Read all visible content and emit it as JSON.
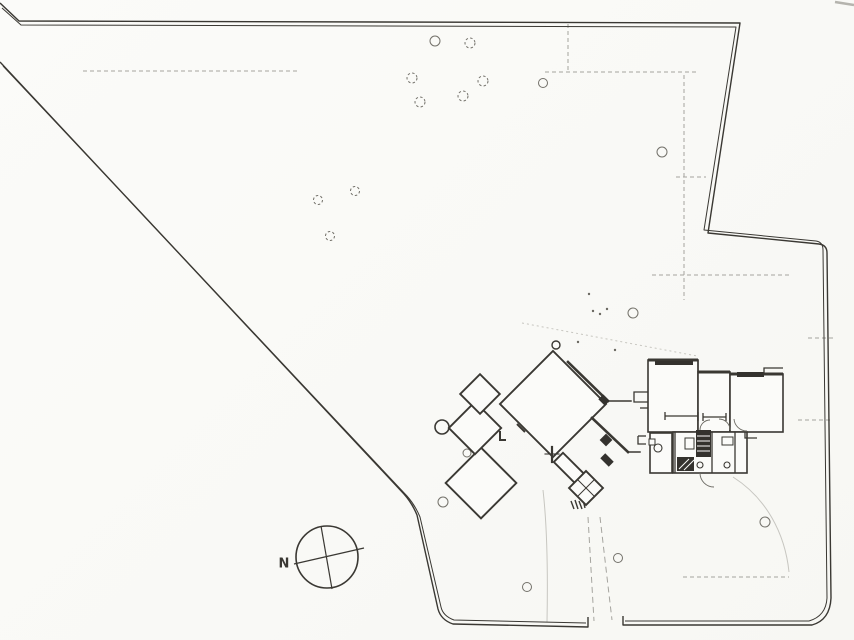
{
  "document": {
    "kind": "architectural site plan (scanned line drawing)",
    "compass_label": "N"
  },
  "palette": {
    "paper": "#fbfbf9",
    "ink": "#3a3833",
    "ink_light": "#6b6962",
    "fill_dark": "#34322e",
    "faint": "#c7c6c0",
    "dashed": "#a5a49e",
    "tree": "#73716a",
    "smudge": "#b5b4ae"
  },
  "compass": {
    "label": "N",
    "cx": 327,
    "cy": 557,
    "r": 31,
    "needles": [
      [
        294,
        564,
        364,
        548
      ],
      [
        321,
        526,
        332,
        589
      ]
    ],
    "label_x": 284,
    "label_y": 562,
    "label_size": 13
  },
  "site": {
    "boundary_outer": [
      "M 0 3 L 19 21 L 740 23 L 708 233 L 819 244 Q 827 245 827 253 L 831 598 Q 830 620 812 625 L 623 625 L 623 616",
      "M 0 62 L 404 494 Q 412 503 417 515 L 438 609 Q 441 620 453 624 L 588 627 L 588 617"
    ],
    "boundary_inner": [
      "M 2 8 L 21 25 L 736 27 L 704 230 L 816 241 Q 823 242 823 250 L 827 598 Q 826 616 809 621 L 625 621",
      "M 3 66 L 407 496 Q 415 505 420 517 L 441 607 Q 443 616 454 620 L 586 623"
    ],
    "dashed_lines": [
      {
        "d": "M 83 71 L 300 71"
      },
      {
        "d": "M 545 72 L 697 72"
      },
      {
        "d": "M 568 24 L 568 71"
      },
      {
        "d": "M 684 75 L 684 300"
      },
      {
        "d": "M 652 275 L 792 275"
      },
      {
        "d": "M 676 177 L 706 177"
      },
      {
        "d": "M 808 338 L 833 338"
      },
      {
        "d": "M 798 420 L 833 420"
      },
      {
        "d": "M 683 577 L 789 577"
      },
      {
        "d": "M 522 323 L 697 356",
        "light": true
      }
    ],
    "driveway_dashed": [
      "M 588 517 L 594 621",
      "M 600 517 L 612 620"
    ],
    "faint_paths": [
      "M 543 490 C 547 525 548 570 547 622",
      "M 733 477 C 766 498 785 533 789 572"
    ],
    "scribble": "M 571 501 L 574 509 M 575 500 L 578 509 M 579 501 L 582 509 M 583 500 L 585 508",
    "smudge": "M 835 2 L 854 5",
    "dots": [
      [
        593,
        311
      ],
      [
        600,
        314
      ],
      [
        607,
        309
      ],
      [
        589,
        294
      ],
      [
        578,
        342
      ],
      [
        615,
        350
      ],
      [
        712,
        394
      ],
      [
        716,
        398
      ]
    ],
    "trees": [
      {
        "x": 435,
        "y": 41,
        "r": 5
      },
      {
        "x": 470,
        "y": 43,
        "r": 5,
        "dashed": true
      },
      {
        "x": 412,
        "y": 78,
        "r": 5,
        "dashed": true
      },
      {
        "x": 483,
        "y": 81,
        "r": 5,
        "dashed": true
      },
      {
        "x": 543,
        "y": 83,
        "r": 4.5
      },
      {
        "x": 463,
        "y": 96,
        "r": 5,
        "dashed": true
      },
      {
        "x": 420,
        "y": 102,
        "r": 5,
        "dashed": true
      },
      {
        "x": 662,
        "y": 152,
        "r": 5
      },
      {
        "x": 355,
        "y": 191,
        "r": 4.5,
        "dashed": true
      },
      {
        "x": 318,
        "y": 200,
        "r": 4.5,
        "dashed": true
      },
      {
        "x": 330,
        "y": 236,
        "r": 4.5,
        "dashed": true
      },
      {
        "x": 633,
        "y": 313,
        "r": 5
      },
      {
        "x": 442,
        "y": 427,
        "r": 7,
        "bold": true
      },
      {
        "x": 467,
        "y": 453,
        "r": 4
      },
      {
        "x": 443,
        "y": 502,
        "r": 5
      },
      {
        "x": 618,
        "y": 558,
        "r": 4.5
      },
      {
        "x": 527,
        "y": 587,
        "r": 4.5
      },
      {
        "x": 765,
        "y": 522,
        "r": 5
      }
    ]
  },
  "building": {
    "diagonal_wing": {
      "rooms": [
        {
          "cx": 481,
          "cy": 483,
          "w": 50,
          "h": 50
        },
        {
          "cx": 475,
          "cy": 428,
          "w": 37,
          "h": 37
        },
        {
          "cx": 480,
          "cy": 394,
          "w": 28,
          "h": 28
        },
        {
          "cx": 553,
          "cy": 404,
          "w": 75,
          "h": 75
        },
        {
          "cx": 569,
          "cy": 468,
          "w": 30,
          "h": 13
        },
        {
          "cx": 586,
          "cy": 488,
          "w": 24,
          "h": 24
        }
      ],
      "x_lines": [
        "M 578 480 L 594 496",
        "M 594 480 L 578 496"
      ],
      "flag": {
        "cx": 556,
        "cy": 345,
        "r": 4
      },
      "walls": [
        {
          "d": "M 568 362 L 608 401",
          "w": 2.6
        },
        {
          "d": "M 608 401 L 631 401",
          "w": 1.5
        },
        {
          "d": "M 592 418 L 628 452",
          "w": 2.6
        },
        {
          "d": "M 628 452 L 640 452",
          "w": 1.5
        },
        {
          "d": "M 552 447 L 552 462",
          "w": 2.2
        },
        {
          "d": "M 545 454 L 559 454",
          "w": 1.1
        }
      ],
      "solids": [
        {
          "cx": 604,
          "cy": 400,
          "w": 9,
          "h": 7
        },
        {
          "cx": 606,
          "cy": 440,
          "w": 9,
          "h": 9
        },
        {
          "cx": 607,
          "cy": 460,
          "w": 12,
          "h": 7
        }
      ],
      "marks": [
        "M 500 431 L 500 440 L 506 440",
        "M 517 424 L 525 432"
      ]
    },
    "ortho_wing": {
      "rooms": [
        [
          648,
          360,
          50,
          72
        ],
        [
          698,
          372,
          32,
          60
        ],
        [
          730,
          374,
          53,
          58
        ],
        [
          673,
          432,
          74,
          41
        ],
        [
          650,
          433,
          22,
          40
        ]
      ],
      "thick_walls": [
        "M 648 360 L 698 360",
        "M 698 372 L 730 372",
        "M 730 374 L 783 374"
      ],
      "dark_bands": [
        [
          737,
          372,
          27,
          5
        ],
        [
          655,
          361,
          38,
          4
        ]
      ],
      "walls": [
        "M 665 416 L 698 416",
        "M 665 412 L 665 420",
        "M 698 412 L 698 421",
        "M 703 417 L 726 417",
        "M 703 413 L 703 421",
        "M 726 413 L 726 421",
        "M 698 360 L 698 372",
        "M 675 432 L 675 473",
        "M 712 432 L 712 473",
        "M 735 432 L 735 473",
        "M 648 392 L 634 392 L 634 402 L 648 402",
        "M 640 408 L 648 408",
        "M 638 436 L 646 436",
        "M 638 436 L 638 444 L 646 444",
        "M 745 432 L 745 438 L 757 438",
        "M 764 374 L 764 368 L 783 368"
      ],
      "stair_treads": {
        "rect": [
          696,
          430,
          15,
          27
        ],
        "tread_ys": [
          436,
          441,
          446,
          451
        ],
        "x1": 697,
        "x2": 710
      },
      "stair_diag": {
        "rect": [
          677,
          457,
          17,
          14
        ],
        "lines": [
          "M 679 469 L 689 459",
          "M 684 470 L 694 460"
        ]
      },
      "fixture_circles": [
        [
          658,
          448,
          4
        ],
        [
          700,
          465,
          3
        ],
        [
          727,
          465,
          3
        ]
      ],
      "fixture_rects": [
        [
          685,
          438,
          9,
          11
        ],
        [
          722,
          437,
          11,
          8
        ],
        [
          649,
          439,
          6,
          6
        ]
      ],
      "door_arcs": [
        "M 700 430 A 10 10 0 0 1 710 420",
        "M 730 430 A 11 11 0 0 0 719 419",
        "M 747 431 A 13 13 0 0 1 734 419",
        "M 700 473 A 14 14 0 0 0 714 487"
      ]
    }
  }
}
